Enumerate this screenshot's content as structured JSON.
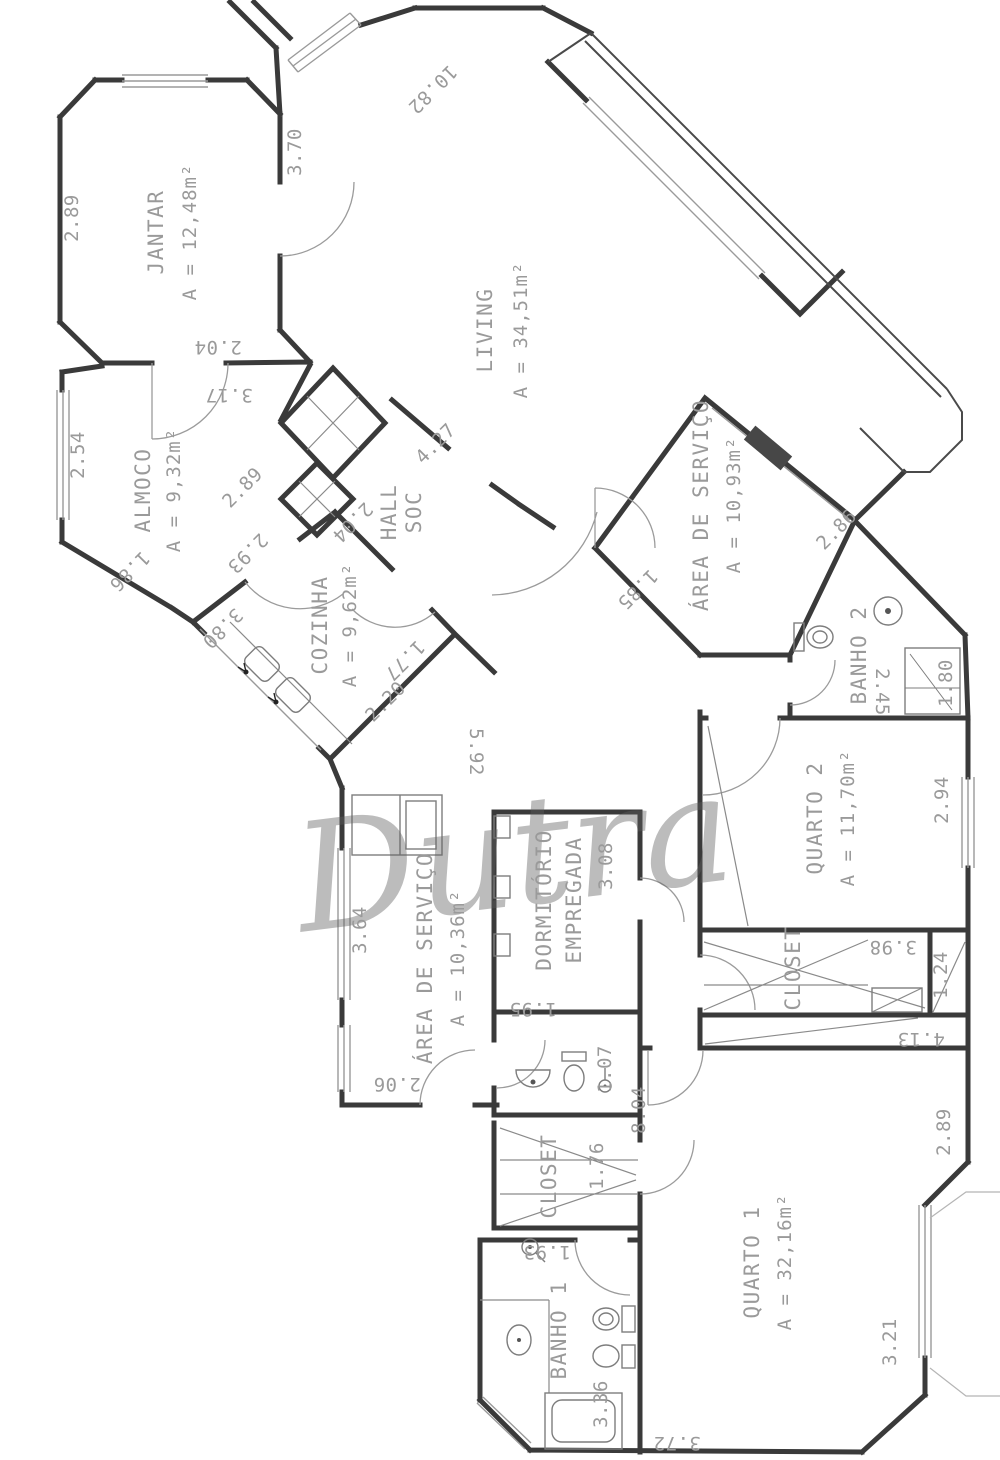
{
  "watermark": "Dutra",
  "rooms": {
    "jantar": {
      "name": "JANTAR",
      "area": "A = 12,48m²"
    },
    "living": {
      "name": "LIVING",
      "area": "A = 34,51m²"
    },
    "almoco": {
      "name": "ALMOCO",
      "area": "A = 9,32m²"
    },
    "cozinha": {
      "name": "COZINHA",
      "area": "A = 9,62m²"
    },
    "hall": {
      "line1": "HALL",
      "line2": "SOC"
    },
    "servico_dir": {
      "name": "ÁREA DE SERVIÇO",
      "area": "A = 10,93m²"
    },
    "banho2": {
      "name": "BANHO 2"
    },
    "quarto2": {
      "name": "QUARTO 2",
      "area": "A = 11,70m²"
    },
    "closet2": {
      "name": "CLOSET"
    },
    "servico_esq": {
      "name": "ÁREA DE SERVIÇO",
      "area": "A = 10,36m²"
    },
    "dormitorio": {
      "line1": "DORMITÓRIO",
      "line2": "EMPREGADA"
    },
    "closet1": {
      "name": "CLOSET"
    },
    "banho1": {
      "name": "BANHO 1"
    },
    "quarto1": {
      "name": "QUARTO 1",
      "area": "A = 32,16m²"
    }
  },
  "dims": [
    "2.89",
    "3.70",
    "10.82",
    "2.04",
    "3.17",
    "2.54",
    "1.86",
    "2.89",
    "2.93",
    "3.80",
    "2.04",
    "4.27",
    "1.77",
    "2.20",
    "5.92",
    "1.85",
    "2.86",
    "2.45",
    "1.80",
    "2.94",
    "3.98",
    "1.24",
    "4.13",
    "3.64",
    "2.06",
    "3.08",
    "1.95",
    "1.07",
    "1.76",
    "8.04",
    "1.93",
    "3.36",
    "3.72",
    "2.89",
    "3.21"
  ]
}
